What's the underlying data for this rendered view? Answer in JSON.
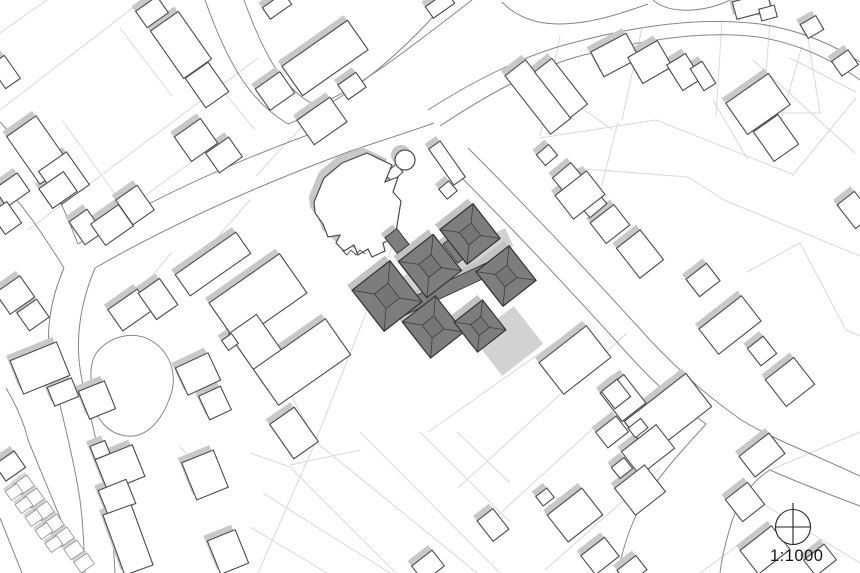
{
  "meta": {
    "drawing_type": "architectural-site-plan",
    "scale_label": "1:1000"
  },
  "colors": {
    "background": "#ffffff",
    "parcel_line": "#d9d9d9",
    "road_edge": "#878787",
    "building_stroke": "#4b4b4b",
    "building_fill": "#ffffff",
    "shadow": "#c8c8c8",
    "garage_stroke": "#9a9a9a",
    "garage_shadow": "#d4d4d4",
    "dark_fill": "#7d7d7d",
    "dark_inner": "#757575",
    "dark_stroke": "#333333",
    "ridge_line": "#3e3e3e",
    "dark_halo": "#c3c3c3",
    "terrace": "#d2d2d2",
    "compass_stroke": "#222222",
    "text": "#161616"
  },
  "north_arrow": {
    "cx": 793,
    "cy": 527,
    "r": 17.5,
    "n_line_top": 503,
    "n_line_bottom": 545
  },
  "scale_label_pos": {
    "x": 770,
    "y": 561
  },
  "plan": {
    "roads": [
      "M205,0 C230,70 252,102 288,124 C342,104 402,54 446,2",
      "M244,0 C264,55 282,88 316,106 C360,88 420,40 472,0",
      "M428,110 C478,78 525,55 572,43 C640,25 700,17 760,24 C800,30 834,45 860,62",
      "M440,126 C487,95 530,71 576,57 C642,40 702,30 758,37 C796,43 830,58 860,80",
      "M78,244 C155,196 242,158 330,127",
      "M95,268 C175,222 262,184 348,152 C380,141 412,131 434,123",
      "M0,122 C20,144 36,164 50,184 C60,198 70,224 78,244",
      "M0,180 C16,198 30,216 42,234 C50,246 58,258 64,268",
      "M64,268 C50,300 44,336 52,372 C62,414 74,460 80,500 C84,530 84,552 85,573",
      "M95,268 C80,304 74,342 82,380 C92,424 104,470 110,510 C113,534 114,554 115,573",
      "M97,352 C110,336 134,330 152,341 C171,353 178,376 170,397 C162,420 147,438 127,436 C108,434 95,419 93,399 C91,382 88,364 97,352",
      "M468,148 C530,210 592,276 650,340 C692,384 716,402 740,419 C758,431 788,444 818,457 L860,476",
      "M452,168 C512,228 570,290 626,352 C660,390 684,408 706,424 C692,440 670,462 650,491 C636,511 624,540 618,573",
      "M860,506 C820,491 790,479 770,470 C752,481 740,499 732,521 C726,541 722,556 720,573",
      "M502,2 C515,16 535,24 558,24 C590,24 620,14 648,4",
      "M653,0 C662,8 676,11 692,10 C706,9 720,5 730,0",
      "M6,388 C16,405 24,422 28,440 L83,573",
      "M0,518 L22,573"
    ],
    "parcels": [
      [
        47,
        0,
        0,
        33
      ],
      [
        143,
        0,
        0,
        110
      ],
      [
        258,
        58,
        28,
        230
      ],
      [
        120,
        28,
        172,
        96
      ],
      [
        62,
        120,
        118,
        198
      ],
      [
        210,
        75,
        255,
        130
      ],
      [
        95,
        232,
        205,
        152
      ],
      [
        172,
        252,
        122,
        312
      ],
      [
        250,
        200,
        196,
        262
      ],
      [
        398,
        232,
        312,
        450
      ],
      [
        312,
        450,
        258,
        573
      ],
      [
        310,
        118,
        256,
        176
      ],
      [
        255,
        330,
        310,
        430
      ],
      [
        570,
        332,
        428,
        432
      ],
      [
        627,
        333,
        458,
        488
      ],
      [
        600,
        422,
        482,
        530
      ],
      [
        660,
        468,
        545,
        570
      ],
      [
        360,
        432,
        500,
        573
      ],
      [
        420,
        432,
        510,
        522
      ],
      [
        457,
        432,
        510,
        483
      ],
      [
        317,
        443,
        477,
        573
      ],
      [
        263,
        493,
        390,
        573
      ],
      [
        250,
        527,
        327,
        573
      ],
      [
        250,
        453,
        290,
        467
      ],
      [
        290,
        467,
        396,
        573
      ],
      [
        180,
        447,
        205,
        473
      ],
      [
        290,
        465,
        360,
        450
      ],
      [
        540,
        138,
        656,
        120
      ],
      [
        656,
        120,
        792,
        174
      ],
      [
        560,
        36,
        540,
        136
      ],
      [
        642,
        28,
        622,
        120
      ],
      [
        722,
        20,
        716,
        116
      ],
      [
        802,
        46,
        772,
        152
      ],
      [
        856,
        98,
        792,
        176
      ],
      [
        770,
        20,
        763,
        113
      ],
      [
        807,
        32,
        820,
        113
      ],
      [
        763,
        113,
        822,
        113
      ],
      [
        560,
        93,
        613,
        130
      ],
      [
        713,
        100,
        748,
        160
      ],
      [
        753,
        60,
        855,
        153
      ],
      [
        560,
        167,
        688,
        177
      ],
      [
        688,
        177,
        724,
        200
      ],
      [
        724,
        200,
        860,
        256
      ],
      [
        790,
        58,
        856,
        92
      ],
      [
        800,
        243,
        846,
        330
      ],
      [
        846,
        330,
        860,
        336
      ],
      [
        747,
        272,
        800,
        243
      ],
      [
        618,
        122,
        596,
        208
      ],
      [
        770,
        470,
        860,
        432
      ],
      [
        740,
        490,
        860,
        563
      ],
      [
        700,
        573,
        770,
        522
      ],
      [
        0,
        452,
        20,
        478
      ],
      [
        0,
        518,
        22,
        573
      ]
    ],
    "houses": [
      [
        152,
        12,
        26,
        20,
        -35
      ],
      [
        181,
        45,
        34,
        58,
        -35
      ],
      [
        207,
        85,
        28,
        36,
        -35
      ],
      [
        196,
        140,
        32,
        30,
        -35
      ],
      [
        224,
        155,
        28,
        24,
        -35
      ],
      [
        5,
        72,
        18,
        28,
        -35
      ],
      [
        38,
        150,
        36,
        58,
        -35
      ],
      [
        64,
        178,
        34,
        40,
        -35
      ],
      [
        12,
        190,
        28,
        22,
        -35
      ],
      [
        58,
        190,
        30,
        24,
        -35
      ],
      [
        6,
        218,
        20,
        26,
        -35
      ],
      [
        86,
        227,
        22,
        28,
        -35
      ],
      [
        112,
        225,
        34,
        26,
        -35
      ],
      [
        135,
        205,
        26,
        30,
        -35
      ],
      [
        15,
        295,
        30,
        26,
        -35
      ],
      [
        33,
        315,
        24,
        22,
        -35
      ],
      [
        130,
        310,
        36,
        26,
        -35
      ],
      [
        158,
        299,
        26,
        32,
        -35
      ],
      [
        213,
        264,
        74,
        26,
        -35
      ],
      [
        275,
        91,
        30,
        26,
        -35
      ],
      [
        322,
        121,
        40,
        30,
        -35
      ],
      [
        325,
        58,
        80,
        36,
        -35
      ],
      [
        352,
        86,
        22,
        18,
        -35
      ],
      [
        277,
        6,
        26,
        14,
        -35
      ],
      [
        440,
        5,
        26,
        14,
        -35
      ],
      [
        447,
        163,
        14,
        44,
        -35
      ],
      [
        448,
        190,
        13,
        13,
        -40
      ],
      [
        538,
        97,
        26,
        74,
        -38
      ],
      [
        561,
        88,
        22,
        58,
        -38
      ],
      [
        615,
        55,
        40,
        28,
        -28
      ],
      [
        650,
        62,
        34,
        30,
        -30
      ],
      [
        684,
        72,
        22,
        30,
        -32
      ],
      [
        703,
        76,
        14,
        26,
        -32
      ],
      [
        752,
        6,
        36,
        18,
        -15
      ],
      [
        768,
        13,
        16,
        12,
        -15
      ],
      [
        812,
        27,
        18,
        16,
        -30
      ],
      [
        845,
        63,
        20,
        18,
        -35
      ],
      [
        855,
        210,
        22,
        30,
        -38
      ],
      [
        758,
        104,
        52,
        38,
        -35
      ],
      [
        776,
        138,
        30,
        36,
        -35
      ],
      [
        547,
        155,
        16,
        14,
        -40
      ],
      [
        568,
        178,
        24,
        20,
        -40
      ],
      [
        592,
        203,
        22,
        20,
        -40
      ],
      [
        612,
        225,
        20,
        18,
        -40
      ],
      [
        580,
        195,
        40,
        30,
        -38
      ],
      [
        610,
        224,
        30,
        26,
        -38
      ],
      [
        640,
        254,
        30,
        38,
        -38
      ],
      [
        703,
        280,
        26,
        22,
        -38
      ],
      [
        730,
        325,
        54,
        32,
        -38
      ],
      [
        762,
        351,
        20,
        22,
        -38
      ],
      [
        790,
        382,
        36,
        34,
        -38
      ],
      [
        668,
        414,
        78,
        42,
        -38
      ],
      [
        623,
        398,
        30,
        36,
        -38
      ],
      [
        648,
        450,
        44,
        30,
        -38
      ],
      [
        640,
        490,
        38,
        34,
        -38
      ],
      [
        622,
        468,
        16,
        14,
        -38
      ],
      [
        638,
        428,
        16,
        12,
        -38
      ],
      [
        612,
        432,
        26,
        20,
        -38
      ],
      [
        575,
        360,
        60,
        40,
        -38
      ],
      [
        616,
        394,
        20,
        22,
        -38
      ],
      [
        575,
        515,
        44,
        34,
        -38
      ],
      [
        545,
        497,
        14,
        12,
        -38
      ],
      [
        600,
        556,
        30,
        24,
        -38
      ],
      [
        632,
        570,
        24,
        18,
        -38
      ],
      [
        493,
        525,
        20,
        26,
        -38
      ],
      [
        428,
        566,
        26,
        20,
        -38
      ],
      [
        762,
        455,
        38,
        26,
        -38
      ],
      [
        745,
        502,
        28,
        28,
        -38
      ],
      [
        765,
        550,
        40,
        30,
        -38
      ],
      [
        820,
        560,
        26,
        20,
        -38
      ],
      [
        198,
        374,
        36,
        30,
        -25
      ],
      [
        215,
        403,
        24,
        26,
        -25
      ],
      [
        205,
        475,
        34,
        40,
        -22
      ],
      [
        228,
        552,
        30,
        36,
        -22
      ],
      [
        40,
        368,
        50,
        36,
        -22
      ],
      [
        63,
        392,
        26,
        20,
        -22
      ],
      [
        97,
        400,
        28,
        30,
        -22
      ],
      [
        10,
        466,
        24,
        20,
        -35
      ],
      [
        120,
        468,
        40,
        34,
        -22
      ],
      [
        100,
        450,
        16,
        14,
        -22
      ],
      [
        117,
        497,
        30,
        26,
        -22
      ],
      [
        128,
        540,
        30,
        64,
        -20
      ],
      [
        258,
        298,
        86,
        48,
        -35
      ],
      [
        262,
        352,
        34,
        68,
        -35
      ],
      [
        302,
        362,
        88,
        44,
        -35
      ],
      [
        294,
        433,
        30,
        42,
        -35
      ],
      [
        230,
        342,
        12,
        12,
        -35
      ]
    ],
    "garages": [
      [
        24,
        485,
        16,
        13,
        -35
      ],
      [
        34,
        498,
        16,
        13,
        -35
      ],
      [
        44,
        511,
        16,
        13,
        -35
      ],
      [
        54,
        524,
        16,
        13,
        -35
      ],
      [
        64,
        537,
        16,
        13,
        -35
      ],
      [
        74,
        550,
        16,
        13,
        -35
      ],
      [
        84,
        563,
        16,
        13,
        -35
      ],
      [
        14,
        492,
        14,
        11,
        -35
      ],
      [
        24,
        505,
        14,
        11,
        -35
      ],
      [
        34,
        518,
        14,
        11,
        -35
      ],
      [
        44,
        531,
        14,
        11,
        -35
      ],
      [
        54,
        544,
        14,
        11,
        -35
      ]
    ],
    "church": {
      "body_path": "M314,202 L324,178 L342,163 L367,153 L392,165 L385,182 L398,177 L393,192 L401,201 L395,238 L383,243 L385,251 L372,257 L368,249 L358,255 L354,245 L344,251 L336,243 L340,235 L328,237 L323,224 L315,213 Z",
      "neck_path": "M385,174 L396,164 L403,172 L392,182 Z",
      "steps_path": "M342,250 l5,5 4,-5 5,5 4,-5 5,4",
      "tower": {
        "cx": 405,
        "cy": 160,
        "r": 10
      }
    },
    "dark_complex": {
      "pavilions": [
        [
          470,
          234,
          42,
          44,
          -38
        ],
        [
          506,
          276,
          42,
          44,
          -38
        ],
        [
          430,
          266,
          44,
          46,
          -38
        ],
        [
          387,
          296,
          48,
          52,
          -38
        ],
        [
          433,
          327,
          42,
          46,
          -38
        ],
        [
          480,
          326,
          36,
          38,
          -38
        ]
      ],
      "links": [
        [
          450,
          287,
          118,
          13,
          -25
        ],
        [
          455,
          250,
          12,
          24,
          -38
        ],
        [
          397,
          241,
          15,
          20,
          -38
        ]
      ],
      "terraces": [
        [
          505,
          338,
          52,
          48,
          -38
        ],
        [
          451,
          260,
          122,
          20,
          -25
        ]
      ]
    }
  }
}
